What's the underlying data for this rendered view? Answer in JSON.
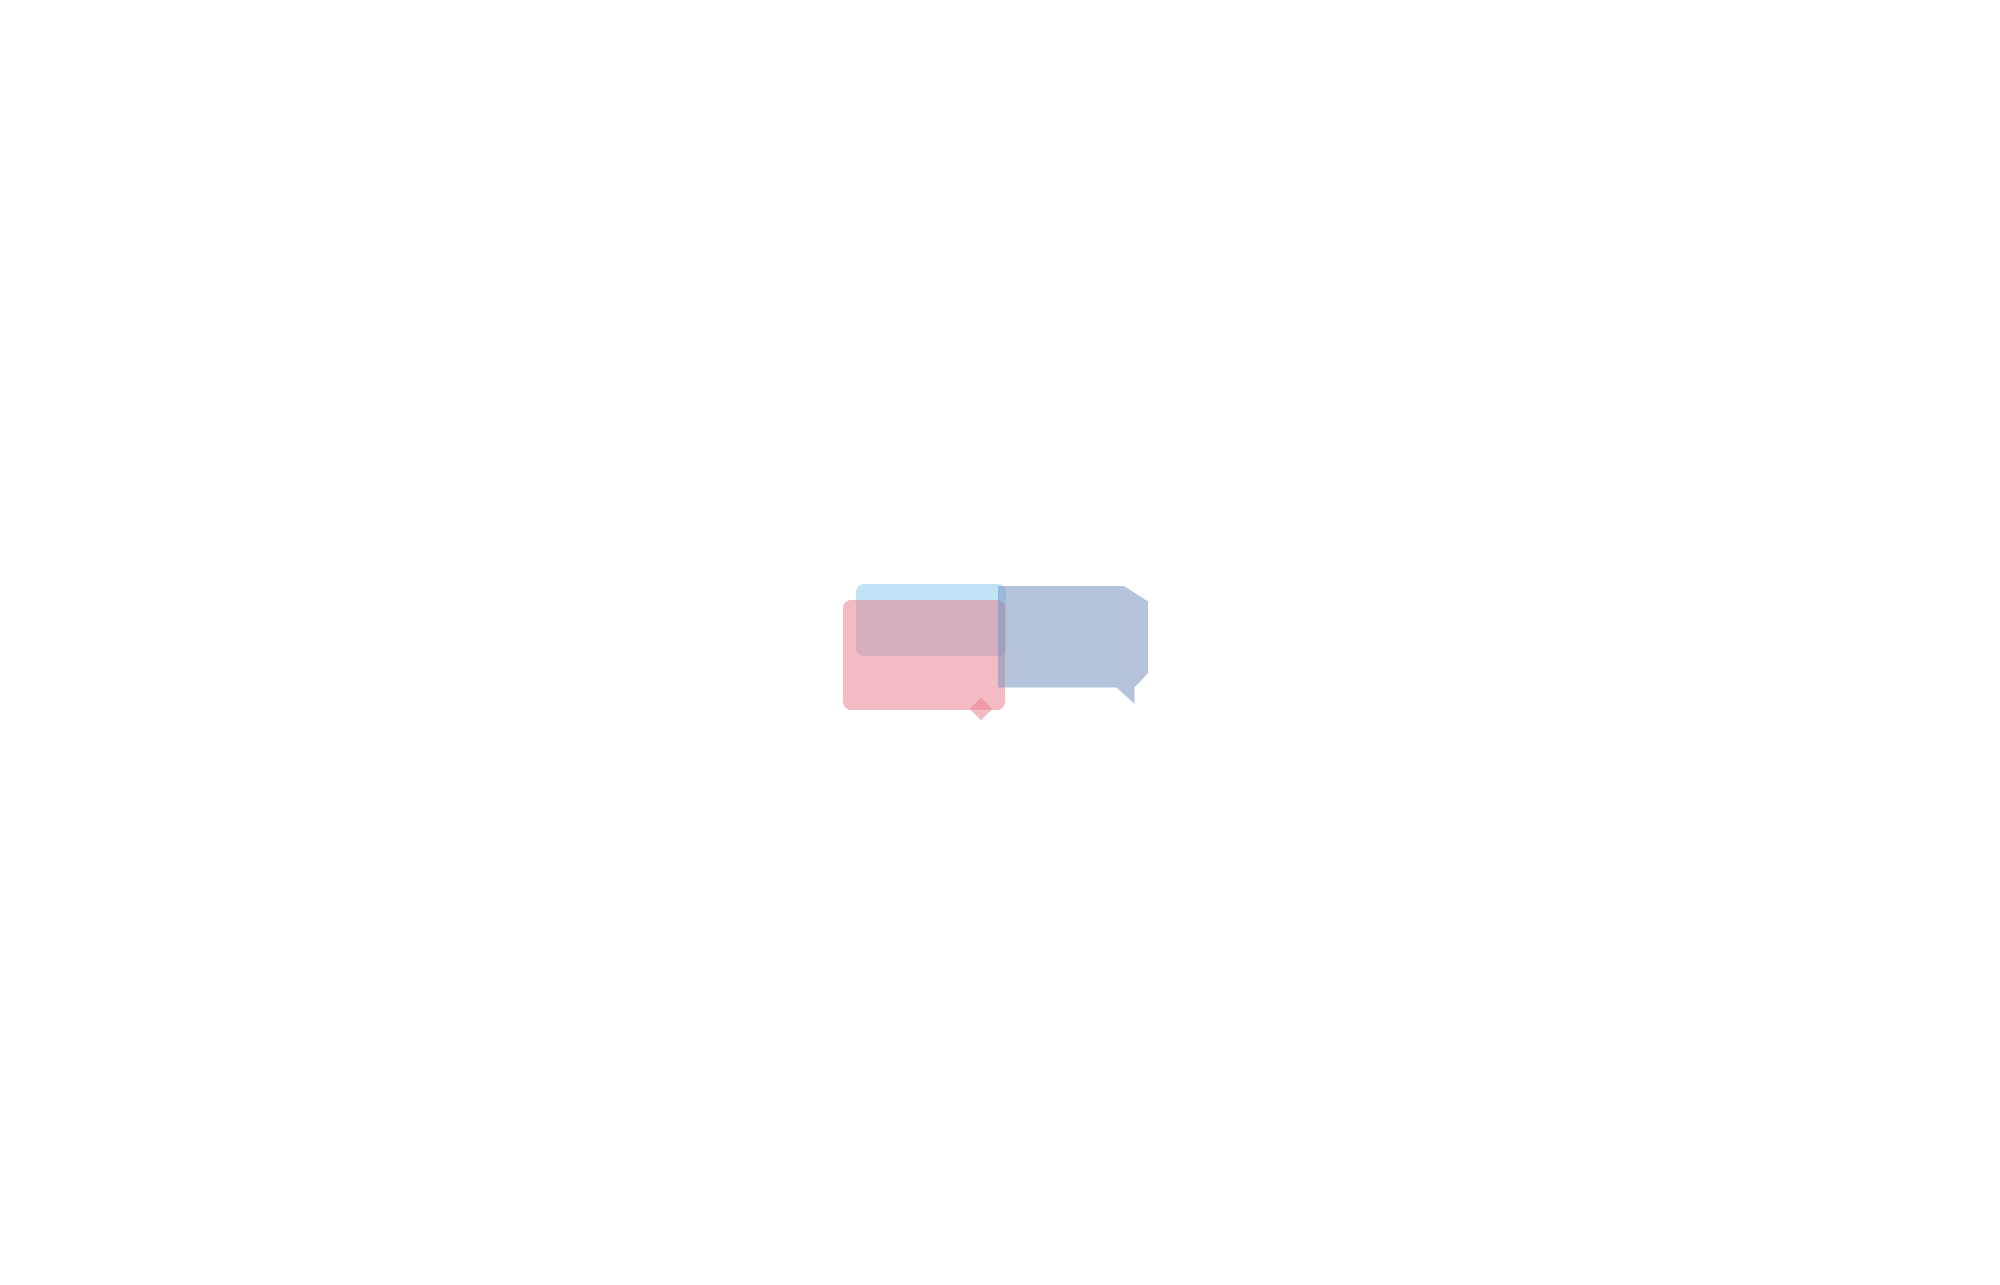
{
  "watermark": {
    "text": "VANDA",
    "pink": "#ec788a",
    "blue": "#7a94be",
    "cyan": "#8cceee"
  },
  "dimensions": {
    "top_total": "24 000",
    "top_segments": [
      "2 400",
      "2 400",
      "2 400",
      "2 400",
      "2 400",
      "2 400",
      "2 400",
      "2 400",
      "2 400",
      "2 400"
    ],
    "left_total": "14 000",
    "left_segments": [
      "6 000",
      "2 000",
      "6 000"
    ]
  },
  "layout": {
    "bays": 10,
    "rooms_per_side": 9,
    "beds_per_side": 18,
    "wardrobes_per_side": 18,
    "toilet_stalls_per_bathroom": 5,
    "washbasins": 2,
    "windows_per_wall": 10,
    "corridor_entrances": 2
  },
  "colors": {
    "wall": "#a9b6be",
    "wall_light": "#b9cedb",
    "wall_stroke": "#2c3338",
    "cap": "#7d8f9c",
    "line": "#1f1f1f",
    "dim": "#1a1a1a",
    "dash": "#111111",
    "blanket": "#e7d2d8",
    "blanket_flap": "#f2e3e7",
    "bed_frame": "#4a3e2f",
    "pillow_frame": "#eac24e",
    "pillow_stroke": "#b5952f",
    "wardrobe": "#b05f3a",
    "wardrobe_stroke": "#1b1b1b",
    "window_glass": "#ffffff"
  }
}
